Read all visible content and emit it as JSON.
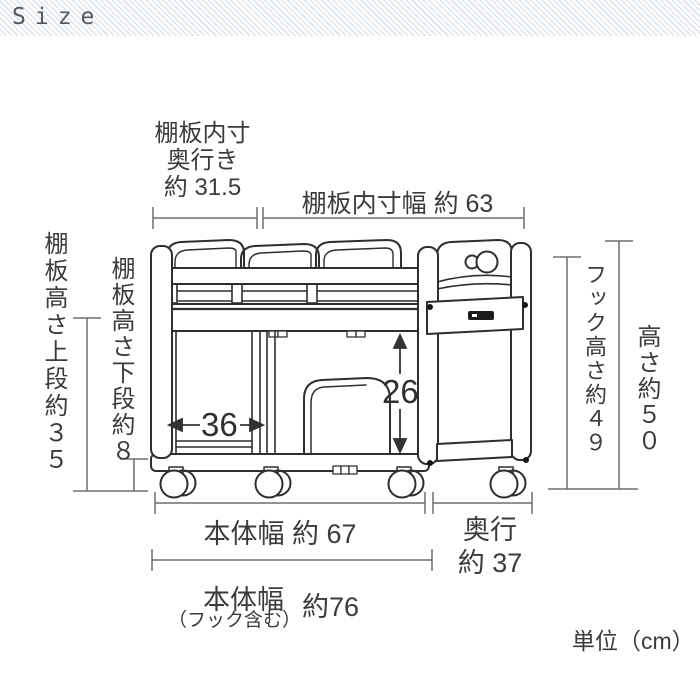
{
  "header": {
    "title": "Size"
  },
  "labels": {
    "shelf_inner_depth_line1": "棚板内寸",
    "shelf_inner_depth_line2": "奥行き",
    "shelf_inner_depth_line3": "約 31.5",
    "shelf_inner_width": "棚板内寸幅 約 63",
    "shelf_height_upper": "棚板高さ上段約３５",
    "shelf_height_lower": "棚板高さ下段約８",
    "hook_height": "フック高さ約４９",
    "overall_height": "高さ約５０",
    "inner_width": "36",
    "inner_height": "26",
    "body_width": "本体幅 約 67",
    "depth_line1": "奥行",
    "depth_line2": "約 37",
    "body_width_hook_line1": "本体幅",
    "body_width_hook_note": "（フック含む）",
    "body_width_hook_value": "約76",
    "unit_note": "単位（cm）"
  },
  "measurements": {
    "unit": "cm",
    "shelf_inner_depth": 31.5,
    "shelf_inner_width": 63,
    "shelf_height_upper": 35,
    "shelf_height_lower": 8,
    "hook_height": 49,
    "overall_height": 50,
    "inner_width": 36,
    "inner_height": 26,
    "body_width": 67,
    "depth": 37,
    "body_width_with_hook": 76
  },
  "colors": {
    "outline": "#2e2e2e",
    "dimension_line": "#6e6e6e",
    "text": "#3b3b3b",
    "header_stripe": "#dfe5ea"
  }
}
